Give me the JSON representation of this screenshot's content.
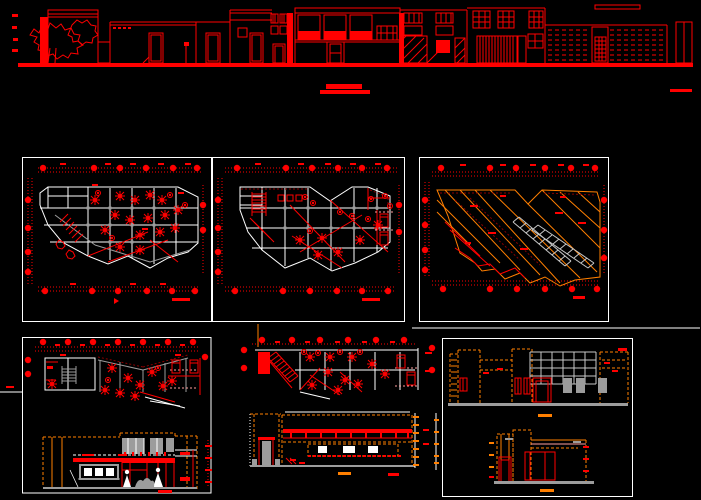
{
  "canvas": {
    "width": 701,
    "height": 500
  },
  "colors": {
    "background": "#000000",
    "red": "#ff0000",
    "white": "#ffffff",
    "gray": "#9c9c9c",
    "light_gray": "#c8c8c8",
    "orange": "#ff7f00",
    "dark_red": "#8b0000",
    "pink": "#ff9f9f"
  },
  "drawings": {
    "street_elevation": {
      "label": "street elevation strip"
    },
    "title_mark": {
      "label": "drawing title mark (illegible small red text)"
    },
    "floor_plan_1": {
      "label": "floor plan - level 1"
    },
    "floor_plan_2": {
      "label": "floor plan - level 2"
    },
    "roof_plan": {
      "label": "roof plan"
    },
    "partial_plan_a": {
      "label": "partial plan with building section"
    },
    "partial_plan_b": {
      "label": "partial plan with building section"
    },
    "elevation_sheet": {
      "label": "front and rear building elevations"
    }
  }
}
